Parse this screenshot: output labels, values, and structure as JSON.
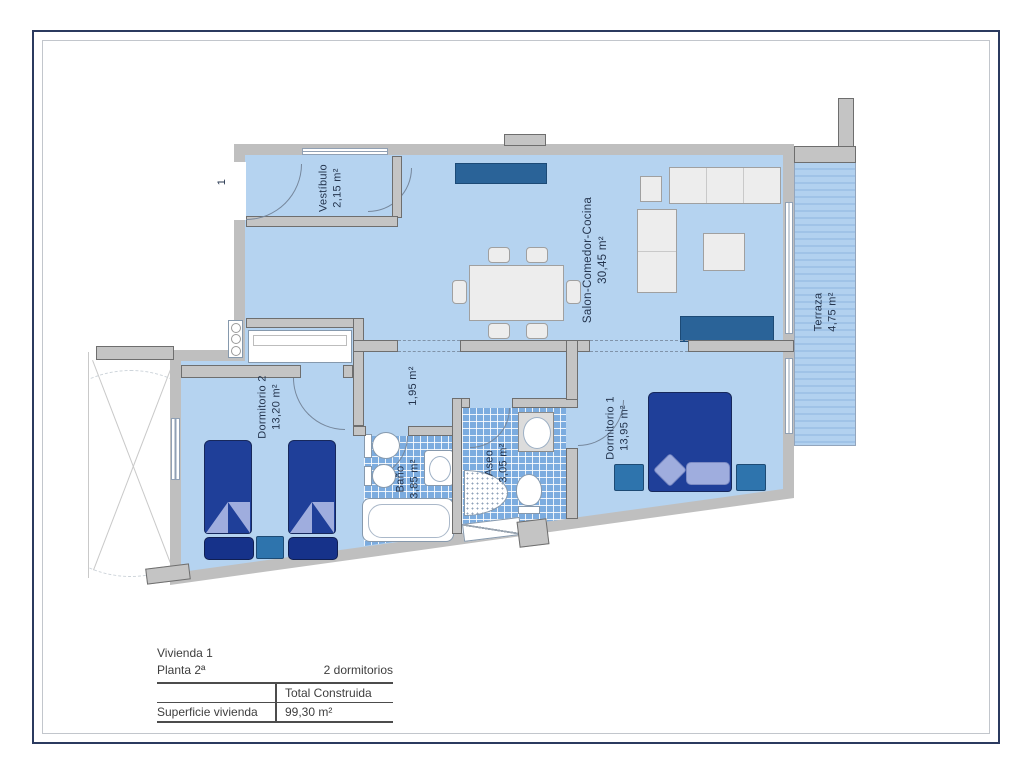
{
  "plan": {
    "entrance_marker": "1",
    "rooms": {
      "vestibulo": {
        "name": "Vestíbulo",
        "area": "2,15 m²"
      },
      "salon": {
        "name": "Salon-Comedor-Cocina",
        "area": "30,45 m²"
      },
      "terraza": {
        "name": "Terraza",
        "area": "4,75 m²"
      },
      "pasillo": {
        "name": "",
        "area": "1,95 m²"
      },
      "dormitorio2": {
        "name": "Dormitorio 2",
        "area": "13,20 m²"
      },
      "bano": {
        "name": "Baño",
        "area": "3,85 m²"
      },
      "aseo": {
        "name": "Aseo",
        "area": "3,05 m²"
      },
      "dormitorio1": {
        "name": "Dormitorio 1",
        "area": "13,95 m²"
      }
    },
    "colors": {
      "room_fill": "#b5d3f0",
      "tile_blue": "#7cacdf",
      "terrace_stripe": "#a0c3e7",
      "wall_gray": "#c4c4c4",
      "furniture_navy": "#1f3f99",
      "furniture_teal": "#2e74ad",
      "furniture_accent": "#2a6398",
      "frame_navy": "#2b3a5f"
    }
  },
  "info": {
    "vivienda": "Vivienda 1",
    "planta": "Planta 2ª",
    "dormitorios": "2 dormitorios",
    "table": {
      "header": "Total Construida",
      "row_label": "Superficie vivienda",
      "value": "99,30 m²"
    }
  }
}
